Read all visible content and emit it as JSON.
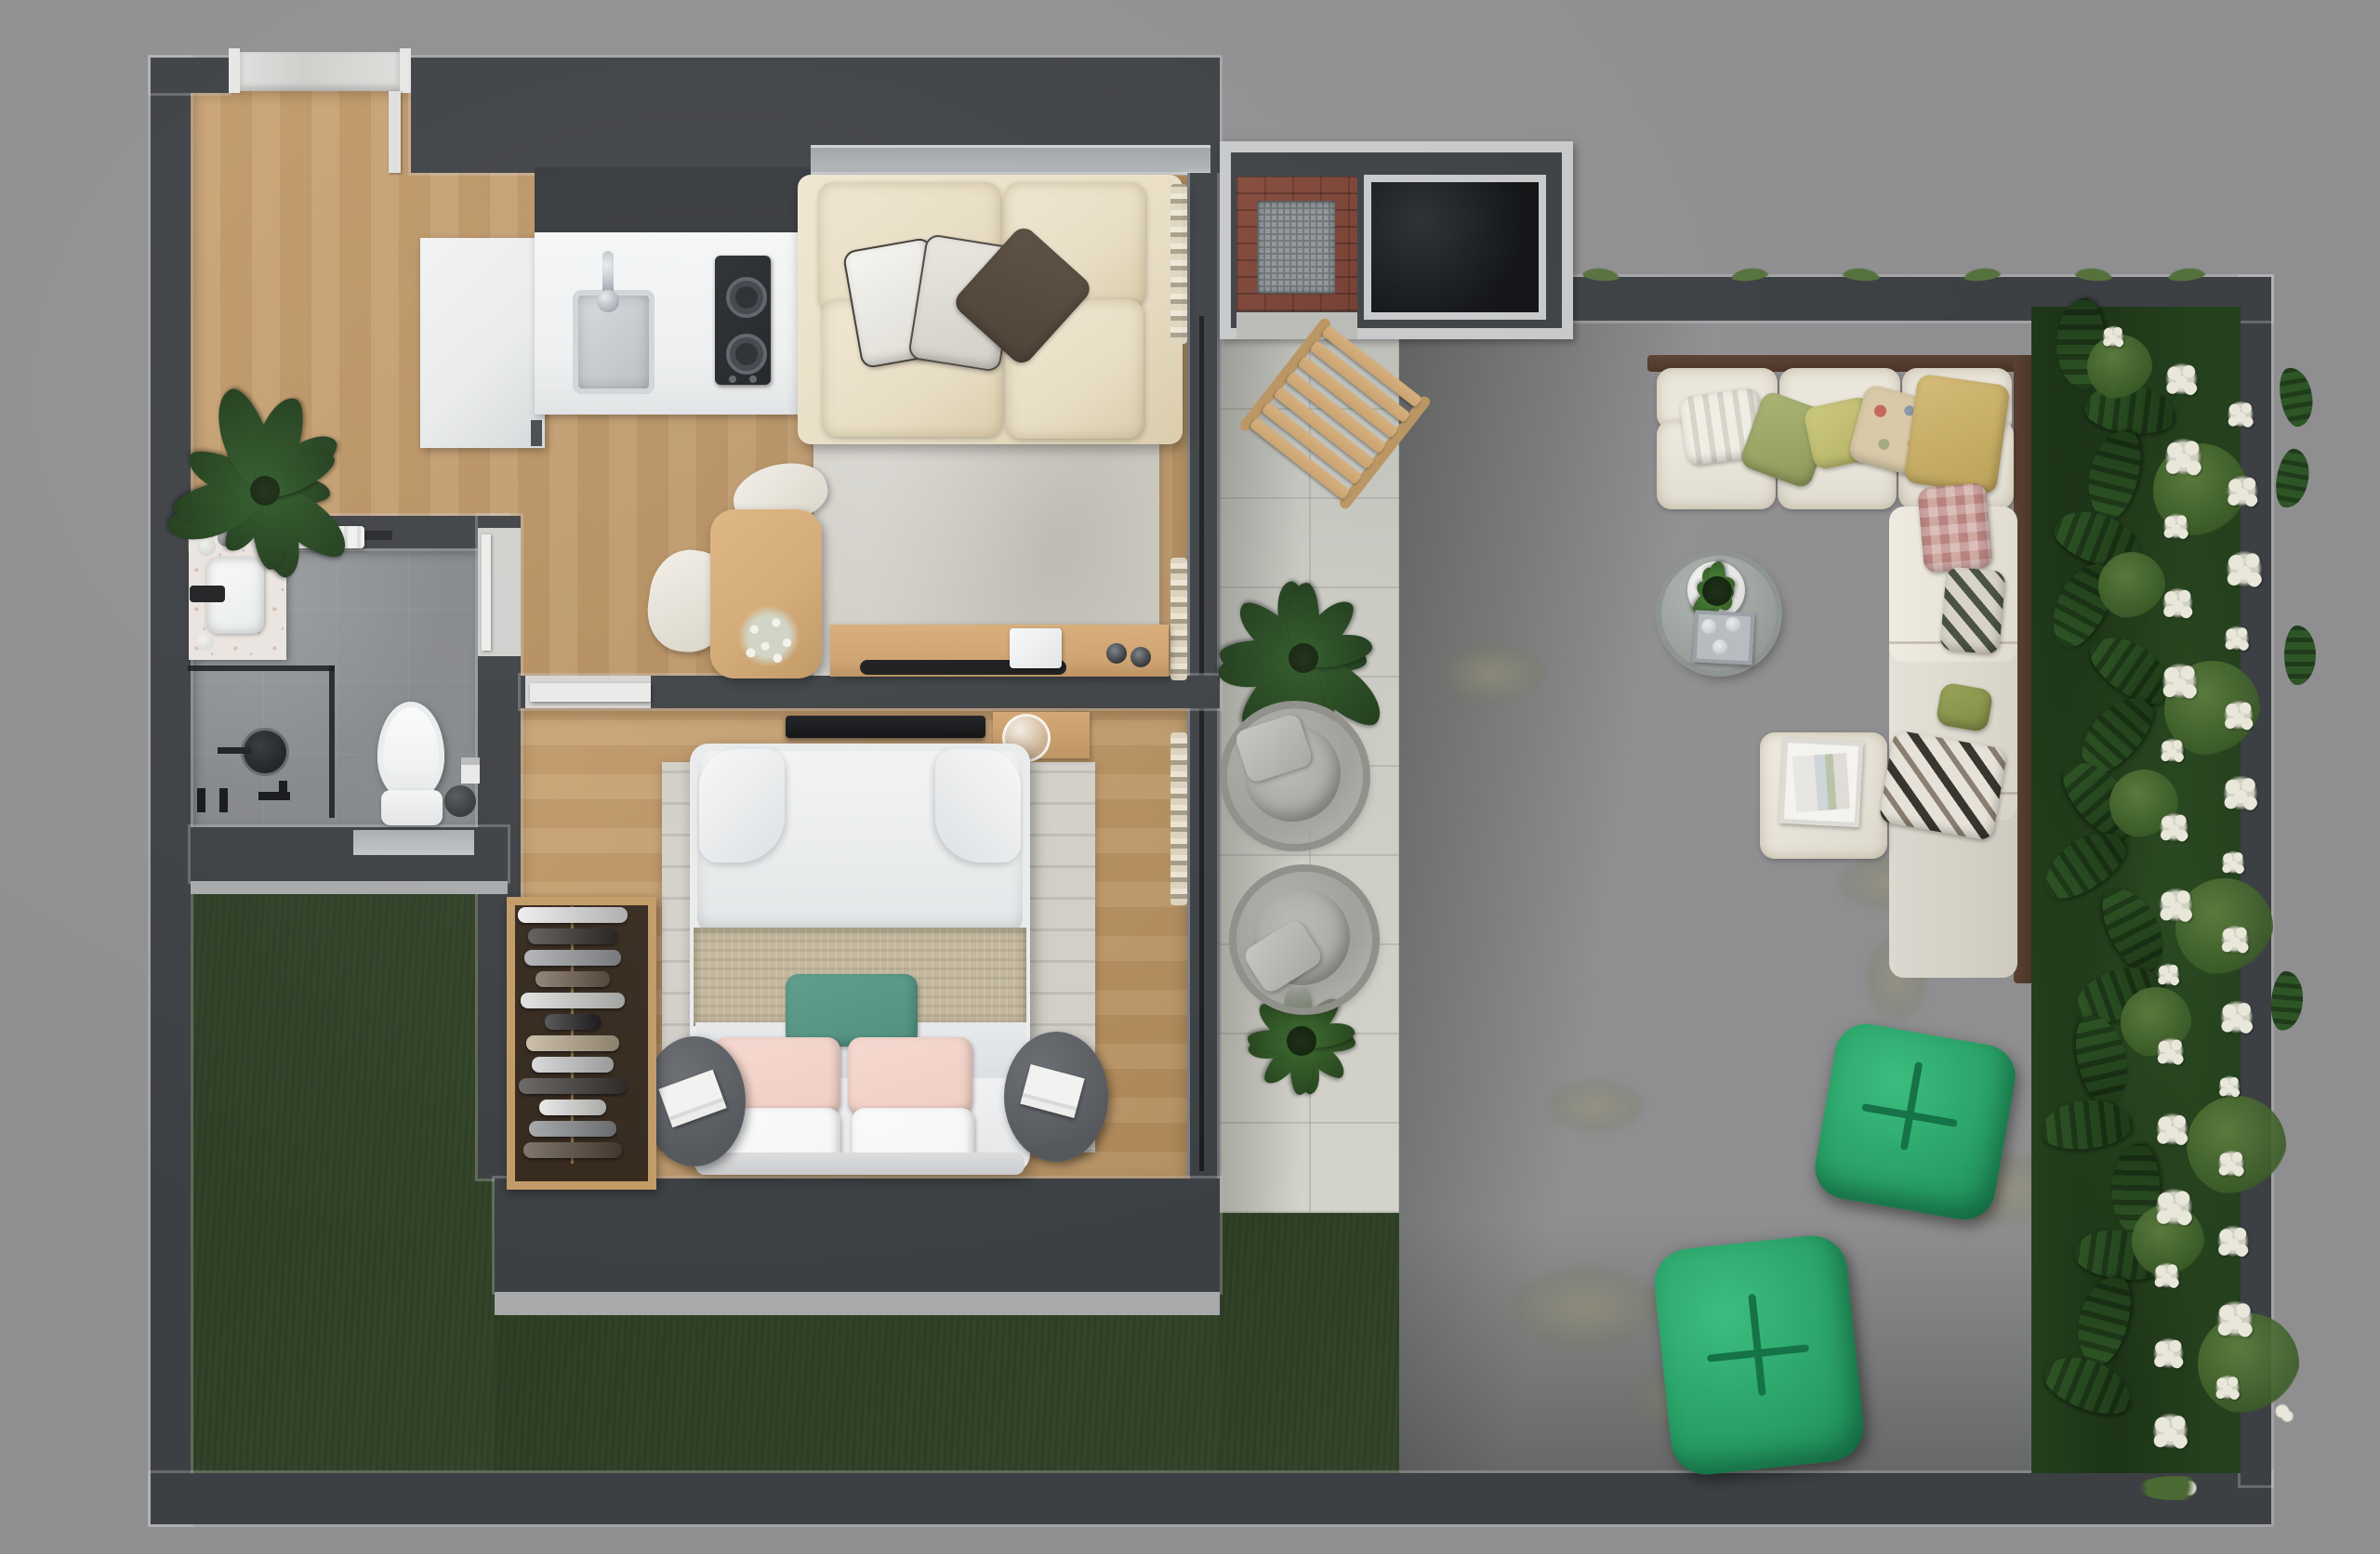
{
  "meta": {
    "title": "Top-down 3D architectural floor plan render — one-bedroom apartment with patio and walled garden",
    "view": "top-down orthographic render",
    "visible_text": "none"
  },
  "palette": {
    "bg": "#8f8f91",
    "wall": "#3c3f43",
    "wallniche": "#32353a",
    "trim": "#a8a9ab",
    "wood": "#c79f6f",
    "wood2": "#b08a5b",
    "bathfloor": "#84878b",
    "concrete": "#c9c9c2",
    "grass": "#4d6836",
    "grassdark": "#33452a",
    "hedge": "#24401d",
    "leaf": "#2f5a28",
    "leaf2": "#3c6b2e",
    "shrub": "#5f8040",
    "flowerwhite": "#e9e7da",
    "cream": "#e7dcc2",
    "rug": "#d1cec7",
    "marble": "#d8d7d5",
    "counter": "#edeff0",
    "cabinet": "#e8eaeb",
    "cooktop": "#17191c",
    "steel": "#aeb4bb",
    "sofabrownpillow": "#46392e",
    "tealpillow": "#4e8d7c",
    "pinkpillow": "#f0cdc2",
    "whitepillow": "#f4f5f6",
    "blanket": "#c2b69a",
    "duvet": "#e9ebec",
    "nightstand": "#54575c",
    "closetwood": "#c19a66",
    "closetinterior": "#362a1f",
    "tablewood": "#d2a873",
    "consolewood": "#cda06d",
    "curtain": "#ded5c0",
    "toilet": "#f2f3f4",
    "vanity": "#e9e4df",
    "blackfixture": "#1d1f22",
    "brick": "#713b2e",
    "grate": "#8e9498",
    "blackcounter": "#0e1013",
    "deckwood": "#4a3426",
    "outdoorcushion": "#eae6db",
    "emerald": "#2aa368",
    "emeralddark": "#157347",
    "graypouf": "#a09f9b",
    "patiotable": "#9aa09c",
    "chairwood": "#c8a06c"
  },
  "rooms": {
    "entry": {
      "features": [
        "marble-threshold",
        "white-door-jambs",
        "open-door-leaf"
      ]
    },
    "kitchen": {
      "appliances": [
        "tall-white-cabinet",
        "white-counter-run",
        "undermount-steel-sink",
        "chrome-faucet",
        "two-burner-black-cooktop"
      ],
      "burners": 2
    },
    "living": {
      "furniture": [
        "cream-two-seat-sofa",
        "gray-area-rug",
        "sheer-curtains",
        "window-sill"
      ],
      "sofa_pillows": [
        {
          "name": "white-piped-pillow",
          "color": "#eef0ee"
        },
        {
          "name": "light-gray-piped-pillow",
          "color": "#dcd9d3"
        },
        {
          "name": "dark-brown-pillow",
          "color": "#46392e"
        }
      ]
    },
    "dining": {
      "furniture": [
        "light-wood-table",
        "white-organic-chair",
        "white-flower-bouquet"
      ]
    },
    "study_wall": {
      "furniture": [
        "wood-sideboard",
        "black-tray",
        "white-laptop",
        "cups"
      ],
      "cups": 2
    },
    "bedroom": {
      "furniture": [
        "double-bed",
        "striped-gray-rug",
        "round-nightstand-left",
        "round-nightstand-right",
        "magazines",
        "wall-tv",
        "wood-shelf-with-glass-dome",
        "open-wardrobe"
      ],
      "bed_pillows": {
        "white": 2,
        "pink": 2,
        "teal": 1
      },
      "wardrobe": {
        "items_count": 12,
        "item_colors": [
          "#e8e8e8",
          "#2e2a26",
          "#9b9da0",
          "#6b5b49",
          "#d8d8d6",
          "#1f1f22",
          "#b9a98f",
          "#caccce",
          "#3a3633",
          "#e2e2e0",
          "#8a8d90",
          "#54473a"
        ]
      }
    },
    "bathroom": {
      "fixtures": [
        "terrazzo-vanity",
        "white-basin",
        "black-faucet",
        "soap-accessories",
        "towel-rail-with-towel",
        "walk-in-shower-glass",
        "black-rain-shower-head",
        "floor-mixer-fittings",
        "wall-hung-toilet",
        "dark-waste-bin",
        "toilet-paper-holder",
        "south-window"
      ]
    },
    "patio": {
      "furniture": [
        "wooden-folding-chair",
        "potted-plant-north",
        "gray-round-lounge-pouf-1",
        "gray-round-lounge-pouf-2",
        "potted-plant-south"
      ],
      "paving": "large-format-concrete-tiles"
    },
    "bbq_area": {
      "features": [
        "brick-barbecue-with-grill-grate",
        "black-counter-inset"
      ]
    },
    "garden": {
      "furniture": [
        "l-shaped-outdoor-sofa",
        "wood-deck-rail",
        "ottoman-chaise-with-tray",
        "round-concrete-coffee-table",
        "potted-green-plant",
        "serving-tray-with-glasses",
        "green-bean-bag-pouf-1",
        "green-bean-bag-pouf-2"
      ],
      "outdoor_sofa_pillows": [
        {
          "name": "white-striped",
          "color": "#e6e2d6"
        },
        {
          "name": "sage-green",
          "color": "#9aa565"
        },
        {
          "name": "yellow-green",
          "color": "#c2c275"
        },
        {
          "name": "beige-floral",
          "color": "#d9c9a8"
        },
        {
          "name": "mustard",
          "color": "#c9b06a"
        },
        {
          "name": "rose-patchwork",
          "color": "#cfa9a0"
        },
        {
          "name": "diamond-print",
          "color": "#d8d3c9"
        },
        {
          "name": "olive",
          "color": "#8f9a4f"
        },
        {
          "name": "black-white-chevron",
          "color": "#d8d5cd"
        }
      ],
      "hedge": {
        "flower_clusters": 30,
        "monstera_leaves": 17,
        "shrub_clumps": 10
      },
      "lawn": "natural-grass-with-worn-patches"
    }
  }
}
